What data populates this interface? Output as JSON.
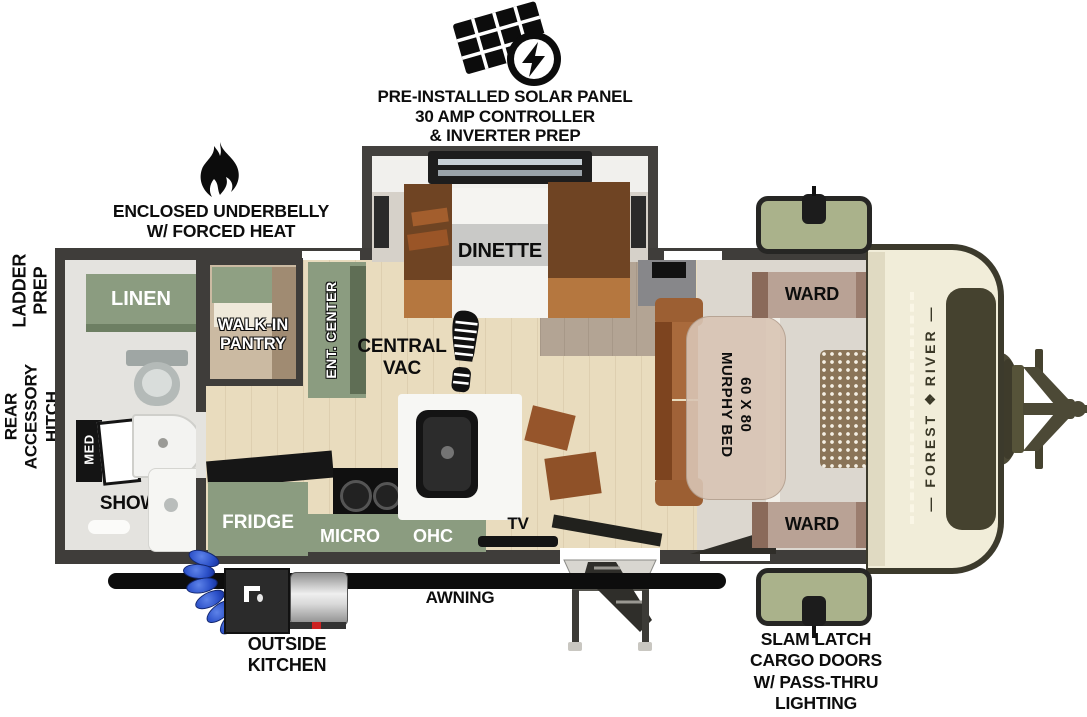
{
  "callouts": {
    "solar": [
      "PRE-INSTALLED SOLAR PANEL",
      "30 AMP CONTROLLER",
      "& INVERTER PREP"
    ],
    "underbelly": [
      "ENCLOSED UNDERBELLY",
      "W/ FORCED HEAT"
    ],
    "ladder_prep": [
      "LADDER",
      "PREP"
    ],
    "rear_hitch": [
      "REAR",
      "ACCESSORY",
      "HITCH"
    ],
    "awning": "AWNING",
    "outside_kitchen": [
      "OUTSIDE",
      "KITCHEN"
    ],
    "cargo_doors": [
      "SLAM LATCH",
      "CARGO DOORS",
      "W/ PASS-THRU",
      "LIGHTING"
    ]
  },
  "rooms": {
    "dinette": "DINETTE",
    "linen": "LINEN",
    "pantry": [
      "WALK-IN",
      "PANTRY"
    ],
    "ent_center": "ENT. CENTER",
    "central_vac": [
      "CENTRAL",
      "VAC"
    ],
    "med": "MED",
    "shower": "SHOWER",
    "fridge": "FRIDGE",
    "micro": "MICRO",
    "ohc": "OHC",
    "tv": "TV",
    "ward_front_top": "WARD",
    "ward_front_bottom": "WARD",
    "murphy_bed": [
      "60 X 80",
      "MURPHY BED"
    ]
  },
  "brand": {
    "word1": "FOREST",
    "word2": "RIVER",
    "rule": "—",
    "emblem": "❖"
  },
  "colors": {
    "wall": "#3f3d3a",
    "floor_wood": "#e9dcbe",
    "floor_gray": "#b3a494",
    "cabinet_green": "#8b9c80",
    "cargo_door_green": "#aab28b",
    "front_cap_cream": "#f1edd9",
    "front_cap_panel": "#45422f",
    "ward_mauve": "#b9a295",
    "sofa_brown": "#a96a3c",
    "bench_brown": "#6f4423",
    "hose_blue": "#2b50c8",
    "ink": "#0d0d0d"
  }
}
